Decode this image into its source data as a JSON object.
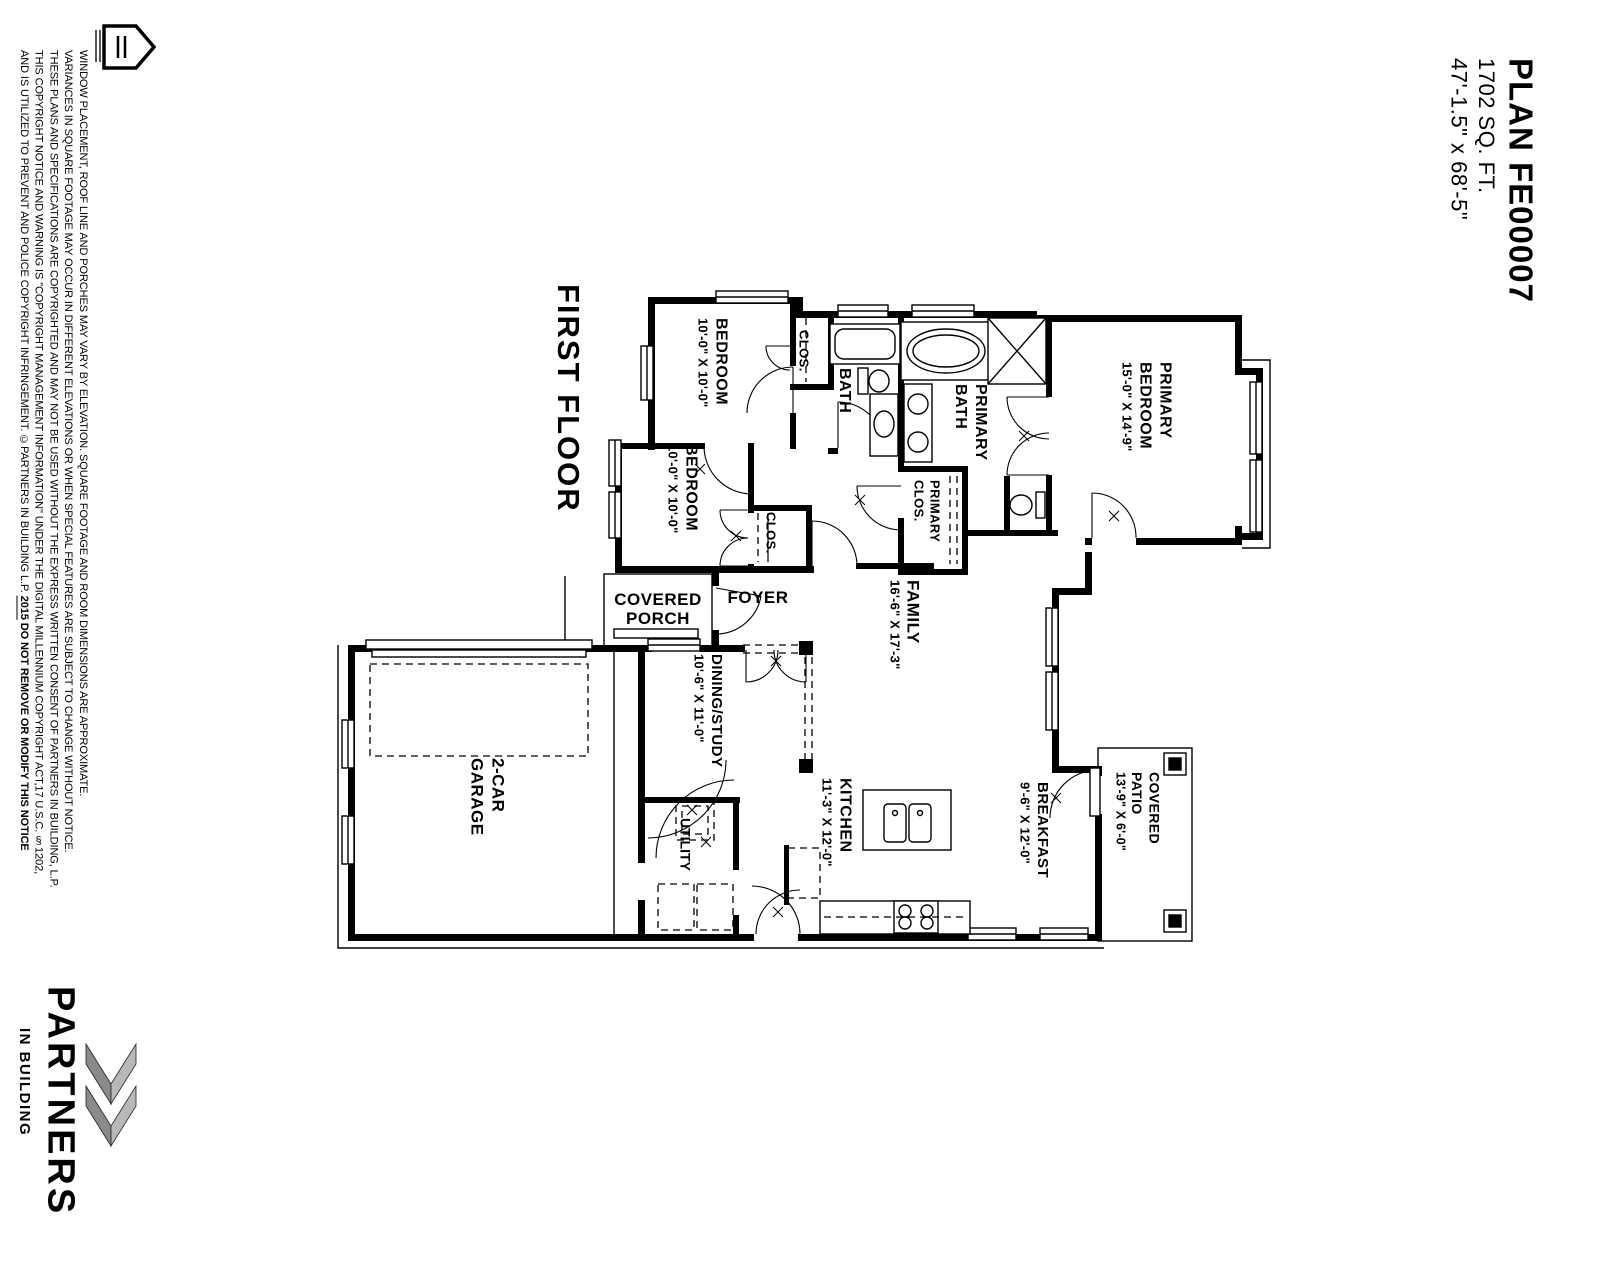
{
  "title_block": {
    "plan_name": "PLAN FE00007",
    "area": "1702 SQ. FT.",
    "footprint": "47'-1.5\" x 68'-5\""
  },
  "plan": {
    "floor_label": "FIRST FLOOR",
    "rooms": {
      "bedroom1": {
        "name": "BEDROOM",
        "dims": "10'-0\" X 10'-0\""
      },
      "bedroom2": {
        "name": "BEDROOM",
        "dims": "10'-0\" X 10'-0\""
      },
      "closet1": {
        "name": "CLOS."
      },
      "closet2": {
        "name": "CLOS."
      },
      "bath": {
        "name": "BATH"
      },
      "primary_bath": {
        "line1": "PRIMARY",
        "line2": "BATH"
      },
      "primary_clos": {
        "line1": "PRIMARY",
        "line2": "CLOS."
      },
      "primary_bedroom": {
        "line1": "PRIMARY",
        "line2": "BEDROOM",
        "dims": "15'-0\" X 14'-9\""
      },
      "family": {
        "name": "FAMILY",
        "dims": "16'-6\" X 17'-3\""
      },
      "dining": {
        "name": "DINING/STUDY",
        "dims": "10'-6\" X 11'-0\""
      },
      "kitchen": {
        "name": "KITCHEN",
        "dims": "11'-3\" X 12'-0\""
      },
      "breakfast": {
        "name": "BREAKFAST",
        "dims": "9'-6\" X 12'-0\""
      },
      "utility": {
        "name": "UTILITY"
      },
      "garage": {
        "line1": "2-CAR",
        "line2": "GARAGE"
      },
      "foyer": {
        "name": "FOYER"
      },
      "covered_porch": {
        "line1": "COVERED",
        "line2": "PORCH"
      },
      "covered_patio": {
        "line1": "COVERED",
        "line2": "PATIO",
        "dims": "13'-9\" X 6'-0\""
      }
    }
  },
  "legal": {
    "lines": [
      "WINDOW PLACEMENT, ROOF LINE AND PORCHES MAY VARY BY ELEVATION.  SQUARE FOOTAGE AND ROOM DIMENSIONS ARE APPROXIMATE.",
      "VARIANCES IN SQUARE FOOTAGE MAY OCCUR IN DIFFERENT ELEVATIONS OR WHEN SPECIAL FEATURES ARE SUBJECT TO CHANGE WITHOUT NOTICE.",
      "THESE PLANS AND SPECIFICATIONS ARE COPYRIGHTED AND MAY NOT BE USED WITHOUT THE EXPRESS WRITTEN CONSENT OF PARTNERS IN BUILDING, L.P.",
      "THIS COPYRIGHT NOTICE AND WARNING IS \"COPYRIGHT MANAGEMENT INFORMATION\" UNDER THE DIGITAL MILLENNIUM COPYRIGHT ACT,17 U.S.C. §1202,"
    ],
    "line5_start": "AND IS UTILIZED TO PREVENT AND POLICE COPYRIGHT INFRINGEMENT.  ©PARTNERS IN BUILDING L.P. ",
    "year": "2015",
    "notice": " DO NOT REMOVE OR MODIFY THIS NOTICE"
  },
  "logo": {
    "company": "PARTNERS",
    "tagline": "IN BUILDING"
  },
  "colors": {
    "ink": "#000000",
    "chevron_dark": "#8a8a8a",
    "chevron_light": "#b8b8b8"
  }
}
